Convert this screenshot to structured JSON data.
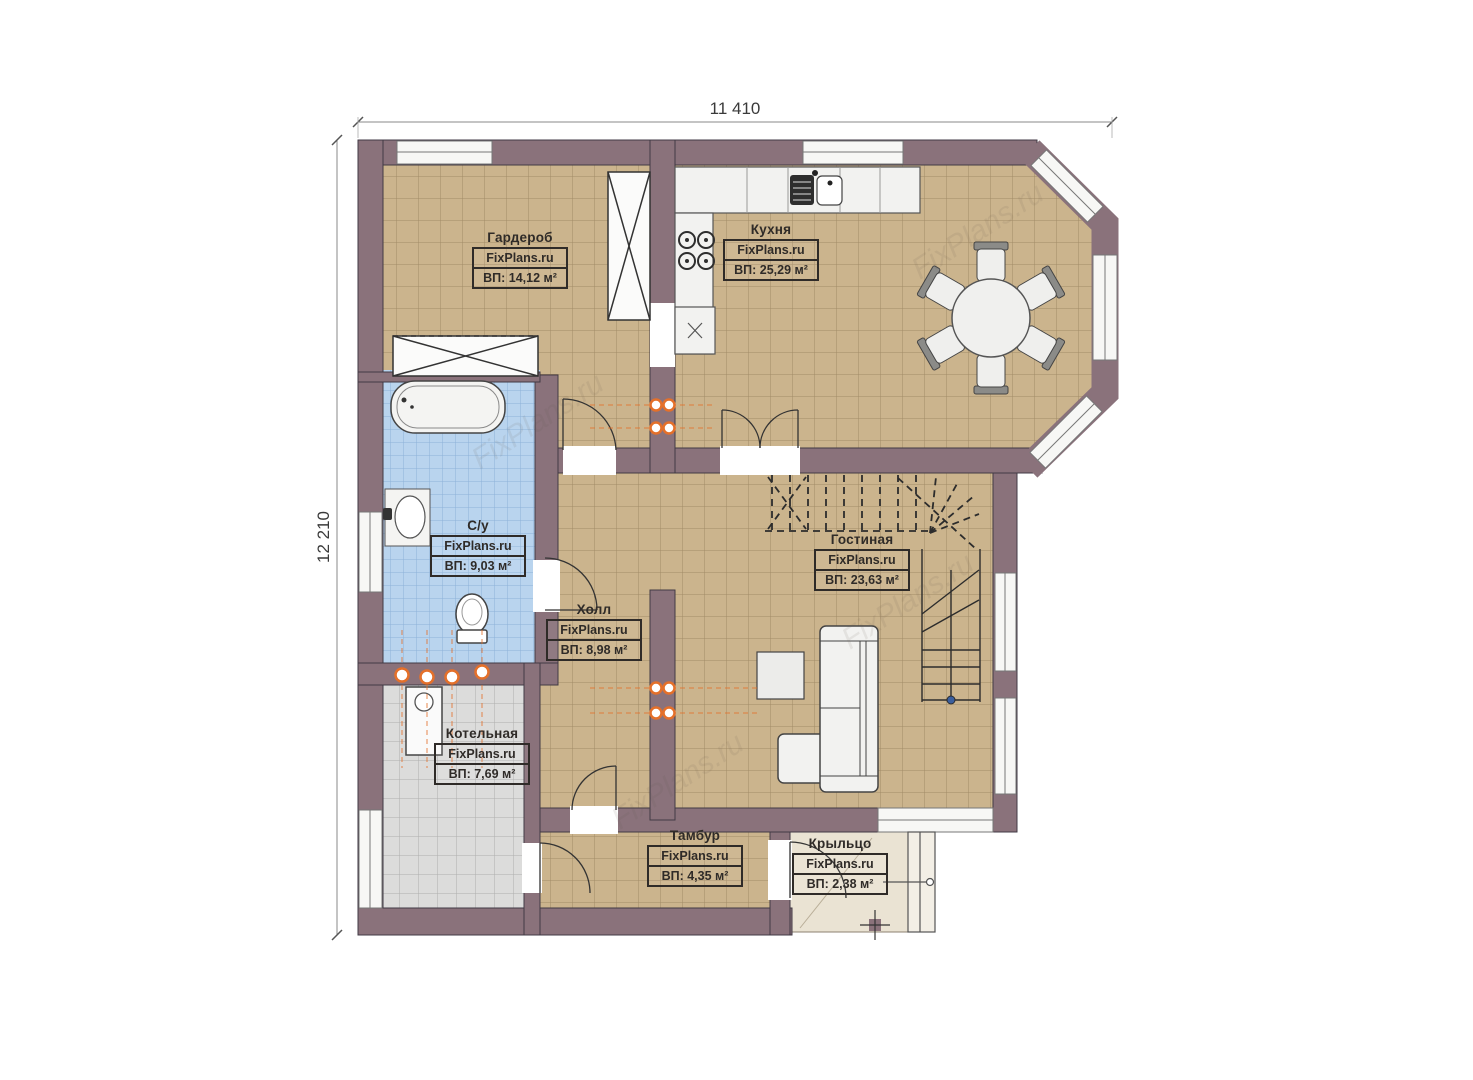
{
  "plan": {
    "dimensions": {
      "width_label": "11 410",
      "height_label": "12 210"
    },
    "watermark": "FixPlans.ru",
    "rooms": [
      {
        "id": "wardrobe",
        "name": "Гардероб",
        "brand": "FixPlans.ru",
        "area": "ВП: 14,12 м²"
      },
      {
        "id": "kitchen",
        "name": "Кухня",
        "brand": "FixPlans.ru",
        "area": "ВП: 25,29 м²"
      },
      {
        "id": "bathroom",
        "name": "С/у",
        "brand": "FixPlans.ru",
        "area": "ВП: 9,03 м²"
      },
      {
        "id": "hall",
        "name": "Холл",
        "brand": "FixPlans.ru",
        "area": "ВП: 8,98 м²"
      },
      {
        "id": "living",
        "name": "Гостиная",
        "brand": "FixPlans.ru",
        "area": "ВП: 23,63 м²"
      },
      {
        "id": "boiler",
        "name": "Котельная",
        "brand": "FixPlans.ru",
        "area": "ВП: 7,69 м²"
      },
      {
        "id": "tambour",
        "name": "Тамбур",
        "brand": "FixPlans.ru",
        "area": "ВП: 4,35 м²"
      },
      {
        "id": "porch",
        "name": "Крыльцо",
        "brand": "FixPlans.ru",
        "area": "ВП: 2,38 м²"
      }
    ],
    "palette": {
      "wall": "#8a727b",
      "floor_tile": "#cbb48d",
      "bath_tile": "#b9d4ee",
      "boiler_tile": "#dcdcdb",
      "porch_floor": "#eae3d3",
      "fixture_fill": "#f2f2f0",
      "plumbing_accent": "#e4702a",
      "line": "#2c2c2c"
    }
  }
}
